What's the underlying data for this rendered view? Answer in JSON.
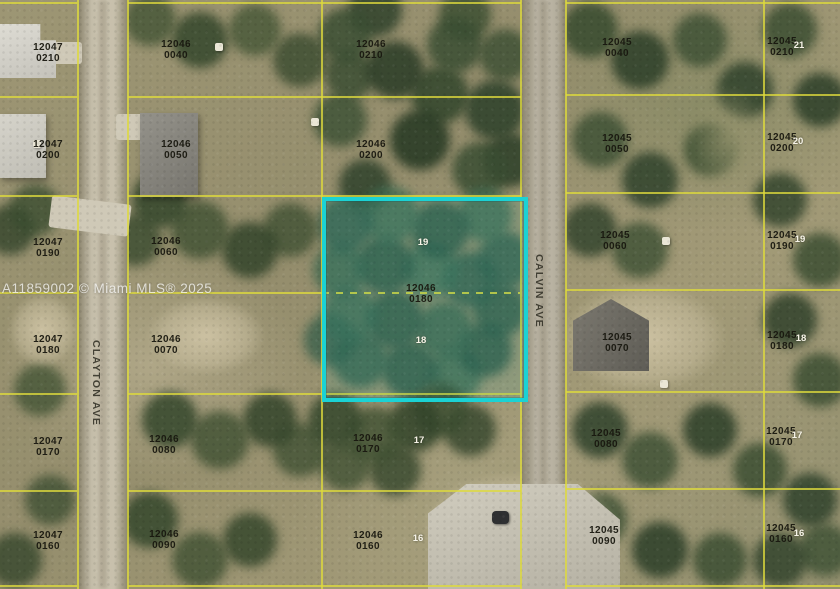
{
  "watermark": {
    "text": "A11859002 © Miami MLS® 2025"
  },
  "streets": [
    {
      "name": "CLAYTON AVE"
    },
    {
      "name": "CALVIN AVE"
    }
  ],
  "highlighted_parcel": {
    "apn": "12046",
    "lot": "0180",
    "outline_color": "#1bd2d4"
  },
  "parcels": [
    {
      "apn": "12047",
      "lot": "0210"
    },
    {
      "apn": "12047",
      "lot": "0200"
    },
    {
      "apn": "12047",
      "lot": "0190"
    },
    {
      "apn": "12047",
      "lot": "0180"
    },
    {
      "apn": "12047",
      "lot": "0170"
    },
    {
      "apn": "12047",
      "lot": "0160"
    },
    {
      "apn": "12046",
      "lot": "0040"
    },
    {
      "apn": "12046",
      "lot": "0050"
    },
    {
      "apn": "12046",
      "lot": "0060"
    },
    {
      "apn": "12046",
      "lot": "0070"
    },
    {
      "apn": "12046",
      "lot": "0080"
    },
    {
      "apn": "12046",
      "lot": "0090"
    },
    {
      "apn": "12046",
      "lot": "0210"
    },
    {
      "apn": "12046",
      "lot": "0200"
    },
    {
      "apn": "12046",
      "lot": "0170"
    },
    {
      "apn": "12046",
      "lot": "0160"
    },
    {
      "apn": "12045",
      "lot": "0040"
    },
    {
      "apn": "12045",
      "lot": "0050"
    },
    {
      "apn": "12045",
      "lot": "0060"
    },
    {
      "apn": "12045",
      "lot": "0070"
    },
    {
      "apn": "12045",
      "lot": "0080"
    },
    {
      "apn": "12045",
      "lot": "0090"
    },
    {
      "apn": "12045",
      "lot": "0210"
    },
    {
      "apn": "12045",
      "lot": "0200"
    },
    {
      "apn": "12045",
      "lot": "0190"
    },
    {
      "apn": "12045",
      "lot": "0180"
    },
    {
      "apn": "12045",
      "lot": "0170"
    },
    {
      "apn": "12045",
      "lot": "0160"
    }
  ],
  "lot_markers": [
    "19",
    "18",
    "17",
    "16",
    "21",
    "20",
    "19",
    "18",
    "17",
    "16"
  ],
  "colors": {
    "boundary_yellow": "#dcda3c",
    "highlight_cyan": "#1bd2d4"
  }
}
